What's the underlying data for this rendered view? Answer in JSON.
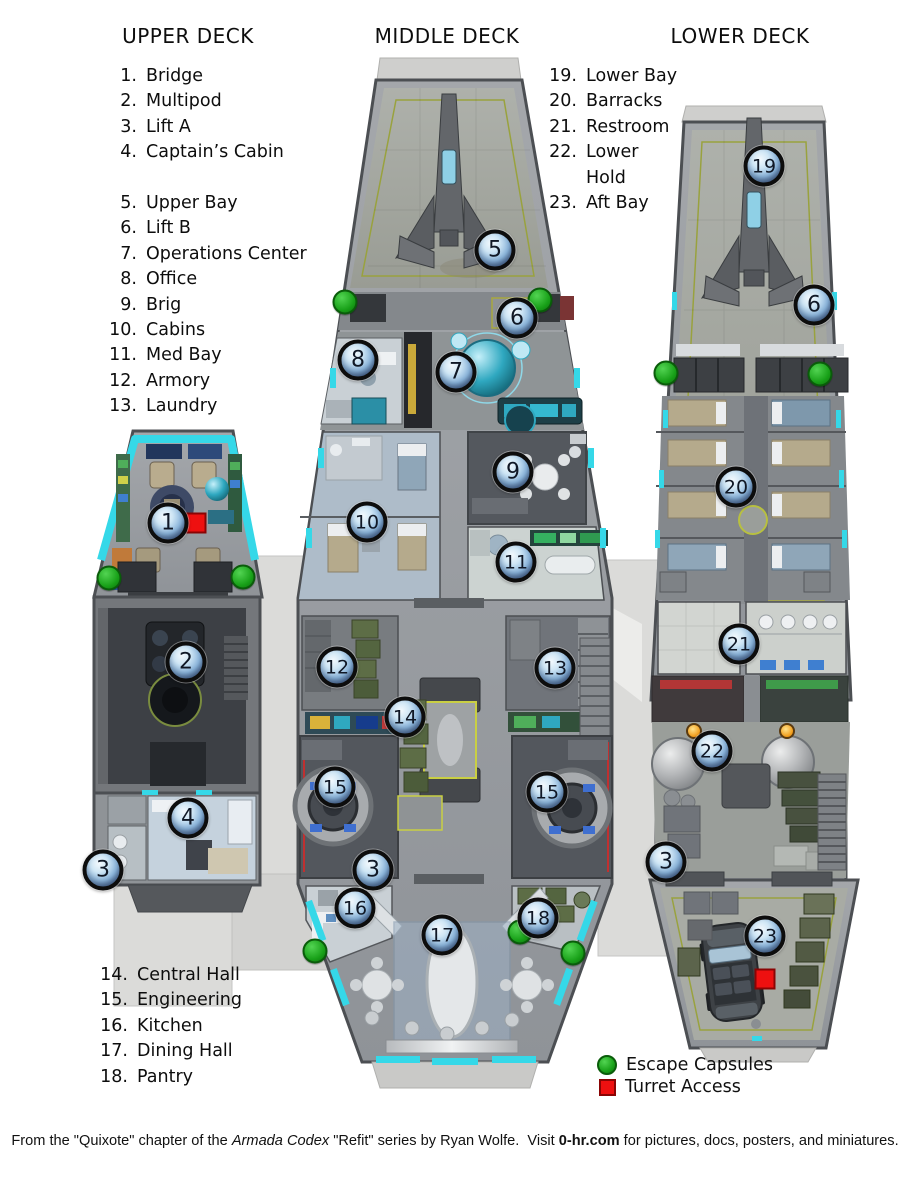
{
  "titles": {
    "upper": "UPPER DECK",
    "middle": "MIDDLE DECK",
    "lower": "LOWER DECK"
  },
  "room_lists": {
    "upper_a": [
      {
        "n": "1.",
        "label": "Bridge"
      },
      {
        "n": "2.",
        "label": "Multipod"
      },
      {
        "n": "3.",
        "label": "Lift A"
      },
      {
        "n": "4.",
        "label": "Captain’s Cabin"
      }
    ],
    "upper_b": [
      {
        "n": "5.",
        "label": "Upper Bay"
      },
      {
        "n": "6.",
        "label": "Lift B"
      },
      {
        "n": "7.",
        "label": "Operations Center"
      },
      {
        "n": "8.",
        "label": "Office"
      },
      {
        "n": "9.",
        "label": "Brig"
      },
      {
        "n": "10.",
        "label": "Cabins"
      },
      {
        "n": "11.",
        "label": "Med Bay"
      },
      {
        "n": "12.",
        "label": "Armory"
      },
      {
        "n": "13.",
        "label": "Laundry"
      }
    ],
    "middle_lower": [
      {
        "n": "14.",
        "label": "Central Hall"
      },
      {
        "n": "15.",
        "label": "Engineering"
      },
      {
        "n": "16.",
        "label": "Kitchen"
      },
      {
        "n": "17.",
        "label": "Dining Hall"
      },
      {
        "n": "18.",
        "label": "Pantry"
      }
    ],
    "lower": [
      {
        "n": "19.",
        "label": "Lower Bay"
      },
      {
        "n": "20.",
        "label": "Barracks"
      },
      {
        "n": "21.",
        "label": "Restroom"
      },
      {
        "n": "22.",
        "label": "Lower\nHold"
      },
      {
        "n": "23.",
        "label": "Aft Bay"
      }
    ]
  },
  "map_markers": [
    {
      "label": "1",
      "x": 168,
      "y": 523
    },
    {
      "label": "2",
      "x": 186,
      "y": 662
    },
    {
      "label": "4",
      "x": 188,
      "y": 818
    },
    {
      "label": "3",
      "x": 103,
      "y": 870
    },
    {
      "label": "5",
      "x": 495,
      "y": 250
    },
    {
      "label": "6",
      "x": 517,
      "y": 318
    },
    {
      "label": "8",
      "x": 358,
      "y": 360
    },
    {
      "label": "7",
      "x": 456,
      "y": 372
    },
    {
      "label": "9",
      "x": 513,
      "y": 472
    },
    {
      "label": "10",
      "x": 367,
      "y": 522
    },
    {
      "label": "11",
      "x": 516,
      "y": 562
    },
    {
      "label": "12",
      "x": 337,
      "y": 667
    },
    {
      "label": "13",
      "x": 555,
      "y": 668
    },
    {
      "label": "14",
      "x": 405,
      "y": 717
    },
    {
      "label": "15",
      "x": 335,
      "y": 787
    },
    {
      "label": "15",
      "x": 547,
      "y": 792
    },
    {
      "label": "3",
      "x": 373,
      "y": 870
    },
    {
      "label": "16",
      "x": 355,
      "y": 908
    },
    {
      "label": "17",
      "x": 442,
      "y": 935
    },
    {
      "label": "18",
      "x": 538,
      "y": 918
    },
    {
      "label": "19",
      "x": 764,
      "y": 166
    },
    {
      "label": "6",
      "x": 814,
      "y": 305
    },
    {
      "label": "20",
      "x": 736,
      "y": 487
    },
    {
      "label": "21",
      "x": 739,
      "y": 644
    },
    {
      "label": "22",
      "x": 712,
      "y": 751
    },
    {
      "label": "3",
      "x": 666,
      "y": 862
    },
    {
      "label": "23",
      "x": 765,
      "y": 936
    }
  ],
  "escape_capsules": [
    {
      "x": 109,
      "y": 578
    },
    {
      "x": 243,
      "y": 577
    },
    {
      "x": 345,
      "y": 302
    },
    {
      "x": 540,
      "y": 300
    },
    {
      "x": 520,
      "y": 932
    },
    {
      "x": 315,
      "y": 951
    },
    {
      "x": 573,
      "y": 953
    },
    {
      "x": 666,
      "y": 373
    },
    {
      "x": 820,
      "y": 374
    }
  ],
  "turret_access": [
    {
      "x": 196,
      "y": 523
    },
    {
      "x": 765,
      "y": 979
    }
  ],
  "hold_lamps": [
    {
      "x": 694,
      "y": 731
    },
    {
      "x": 787,
      "y": 731
    }
  ],
  "legend": {
    "escape_label": "Escape Capsules",
    "turret_label": "Turret Access"
  },
  "colors": {
    "escape_green": "#18a018",
    "turret_red": "#ee1010",
    "accent_cyan": "#35d8e8",
    "marker_ring": "#0d0d0d",
    "lamp_orange": "#f09a18"
  },
  "footer": {
    "part1": "From the \"Quixote\" chapter of the ",
    "italic": "Armada Codex",
    "part2": " \"Refit\" series by Ryan Wolfe.  Visit ",
    "bold": "0-hr.com",
    "part3": " for pictures, docs, posters, and miniatures."
  }
}
